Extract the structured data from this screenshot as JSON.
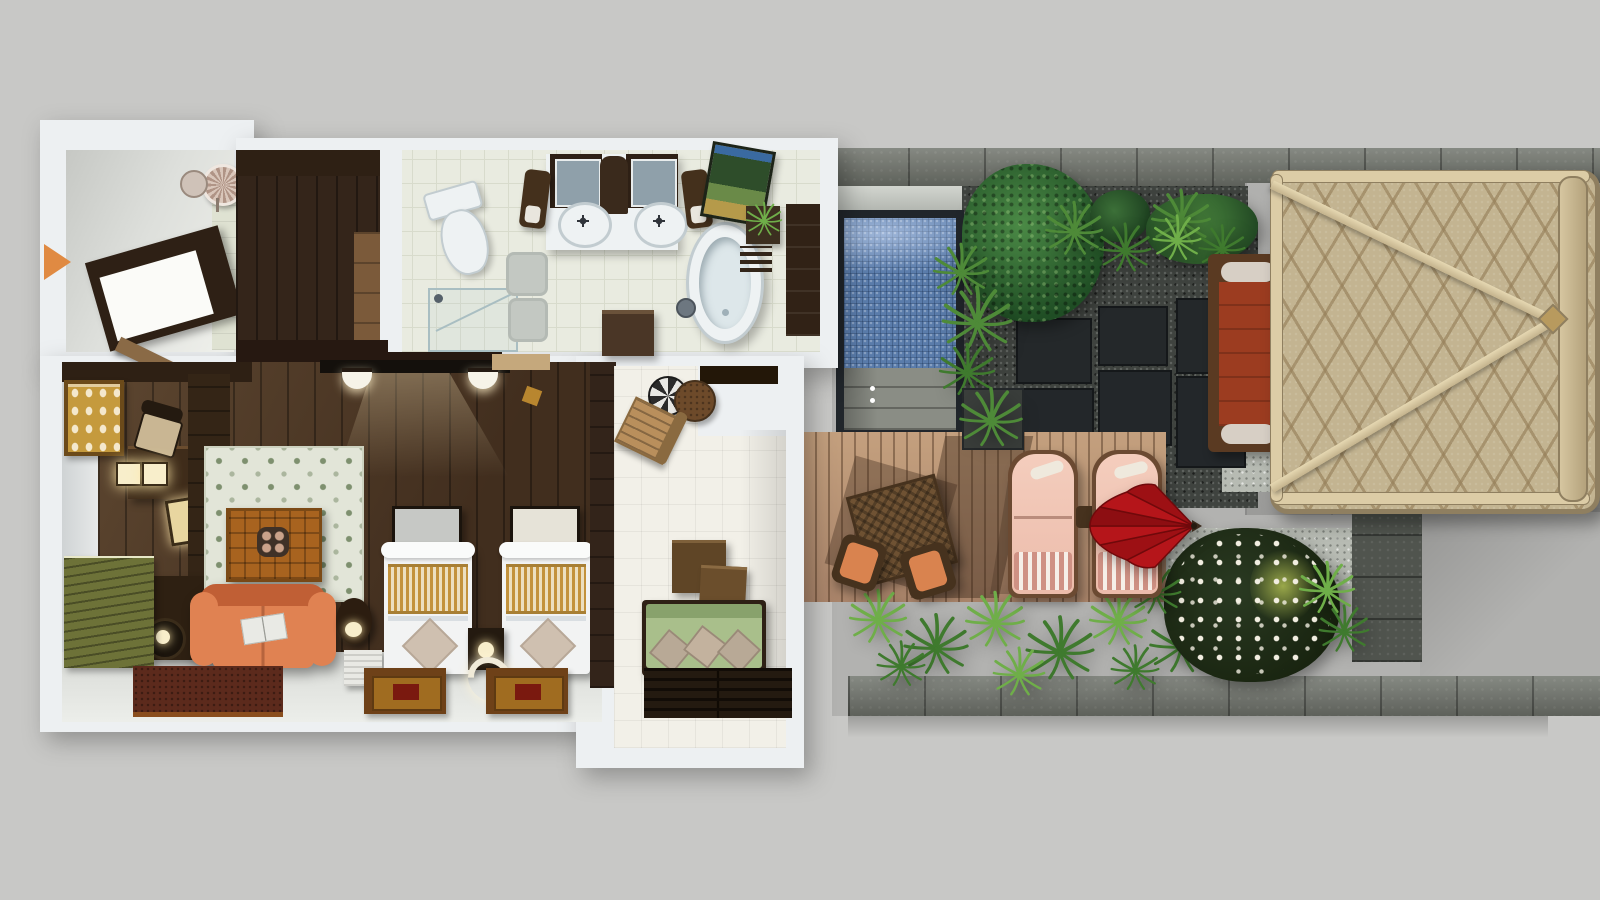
{
  "scene": {
    "type": "3d-floorplan-render",
    "description": "Top-down 3D architectural rendering of a one-bedroom resort villa with bathroom, twin bedroom, garden lounge, plunge pool, timber sun deck and a thatched-roof pavilion. No visible text in the image; a small orange arrow marks the entrance.",
    "entry": {
      "label": "Entrance",
      "marker": "orange-arrow"
    },
    "rooms": {
      "foyer": {
        "label": "Entry Foyer",
        "items": [
          "ceiling-lamp",
          "entry-canopy",
          "door-leaf"
        ]
      },
      "corridor": {
        "label": "Wardrobe Corridor",
        "items": [
          "wardrobe",
          "corridor-door"
        ]
      },
      "bathroom": {
        "label": "Bathroom",
        "items": [
          "toilet",
          "walk-in-shower",
          "bath-mats",
          "double-vanity",
          "vanity-mirrors",
          "twin-sinks",
          "wooden-stools",
          "storage-bench",
          "freestanding-bathtub",
          "green-artwork",
          "plant-stand",
          "towel-rack",
          "linen-wardrobe"
        ]
      },
      "bedroom": {
        "label": "Twin Bedroom",
        "items": [
          "wall-tv",
          "wall-sconces",
          "writing-desk",
          "desk-chair",
          "gold-artwork",
          "wardrobe-column",
          "louvered-bench",
          "floral-area-rug",
          "carved-coffee-table",
          "orange-sofa",
          "drum-side-table",
          "floor-lamp",
          "red-runner-rug",
          "twin-bed-left",
          "twin-bed-right",
          "headboard-panels",
          "shared-nightstand",
          "foot-mats",
          "white-ribbed-bench"
        ]
      },
      "lounge": {
        "label": "Garden Lounge",
        "items": [
          "cafe-table",
          "cafe-chair",
          "nesting-tables",
          "green-daybed",
          "slatted-platform"
        ]
      }
    },
    "outdoor": {
      "label": "Pool Terrace & Garden",
      "items": {
        "pool": {
          "label": "Plunge Pool"
        },
        "pool_steps": {
          "label": "Pool Steps"
        },
        "deck": {
          "label": "Timber Sun Deck"
        },
        "dining": {
          "label": "Wicker Table & Chairs"
        },
        "loungers": {
          "label": "Sun Loungers",
          "count": 2
        },
        "umbrella": {
          "label": "Red Parasol"
        },
        "pavilion": {
          "label": "Thatched-Roof Pavilion"
        },
        "balebed": {
          "label": "Outdoor Daybed"
        },
        "garden": {
          "label": "Tropical Garden"
        },
        "frangipani": {
          "label": "Flowering Frangipani"
        },
        "stones": {
          "label": "Stepping Stones"
        },
        "walls": {
          "label": "Stone Boundary Walls"
        }
      }
    }
  },
  "colors": {
    "bg": "#c8c8c6",
    "slab": "#edf0f2",
    "slab-shade": "#c9d0d5",
    "wall-face": "#d8dcdd",
    "foyer-floor-a": "#c6c8c4",
    "foyer-floor-b": "#f0f1ec",
    "wood-dark": "#2e2014",
    "wood-mid": "#4a3422",
    "wood-plank": "#3a2818",
    "wood-light": "#7c5a38",
    "door-tan": "#8a6a46",
    "lintel": "#261811",
    "tile": "#e9ebe0",
    "tile-line": "#d8dbcc",
    "porcelain": "#eef2f3",
    "porcelain-edge": "#c2ccd0",
    "mirror-glass": "#8fa0aa",
    "frame-dark": "#2e2015",
    "mat-gray": "#c3c8c2",
    "art-green-a": "#2e4d2a",
    "art-green-b": "#6a8a48",
    "art-gold-band": "#b59a4a",
    "glass-line": "#a9bec2",
    "tub-inner": "#dde7ea",
    "stool-wood": "#44301c",
    "gold-art": "#c59a3d",
    "gold-art-frame": "#6b4a1a",
    "olive-panel": "#6d7238",
    "rug-base": "#e2e5d8",
    "rug-motif": "#7e906f",
    "table-orange": "#a8631f",
    "table-grid": "#7c4a16",
    "sofa": "#e08252",
    "sofa-deep": "#c05f35",
    "rug-red": "#5c2a1c",
    "rug-red-trim": "#8a4e1e",
    "bed-white": "#f2f3f3",
    "bed-shade": "#d9dee2",
    "runner-gold": "#c3923c",
    "runner-cream": "#ecdfc0",
    "pillow-taupe": "#cfc0b0",
    "mat-wood": "#6e4118",
    "mat-tan": "#a06c20",
    "mat-red": "#7a190f",
    "glow": "#f8eecb",
    "lamp-warm": "#e8d6a0",
    "arrow": "#e08a42",
    "court-tile": "#f2f0e8",
    "beam-dark": "#231708",
    "daybed-green": "#a9bf8b",
    "daybed-green-dark": "#88a26c",
    "pillow-gray": "#b8a996",
    "platform-dark": "#241a10",
    "ground": "#b2b2b0",
    "concrete": "#a8a8a6",
    "stone": "#72766e",
    "stone-joint": "#50544e",
    "stone-dark": "#3b3f3a",
    "gravel": "#3f433f",
    "gravel-pale": "#b7bbb3",
    "pool-frame": "#21262b",
    "pool-water": "#5a7cab",
    "pool-light": "#93adce",
    "step-stone": "#8a8d85",
    "deck-a": "#c4a07e",
    "deck-b": "#a9846a",
    "wicker": "#6f5233",
    "wicker-dark": "#46321e",
    "cushion-orange": "#d9834f",
    "lounger-pink": "#ecbcab",
    "lounger-light": "#f4cdbd",
    "towel-stripe": "#cf9184",
    "umbrella-red": "#b01217",
    "umbrella-deep": "#8d0e12",
    "grass": "#3f7a2e",
    "grass-light": "#6fae49",
    "palm": "#4e8a38",
    "bush-a": "#4b8a46",
    "bush-b": "#1f4d24",
    "foliage-dark": "#2a3a22",
    "foliage-accent": "#9aa84a",
    "flower-white": "#f2eee1",
    "roof-base": "#c3b491",
    "roof-groove": "#9a8865",
    "roof-beam": "#dccca6",
    "roof-edge": "#8f7f60",
    "bale-frame": "#5a3a22",
    "bale-terracotta": "#9c3c20",
    "bolster": "#d7cfc5",
    "white-bench": "#e9e9e4"
  }
}
